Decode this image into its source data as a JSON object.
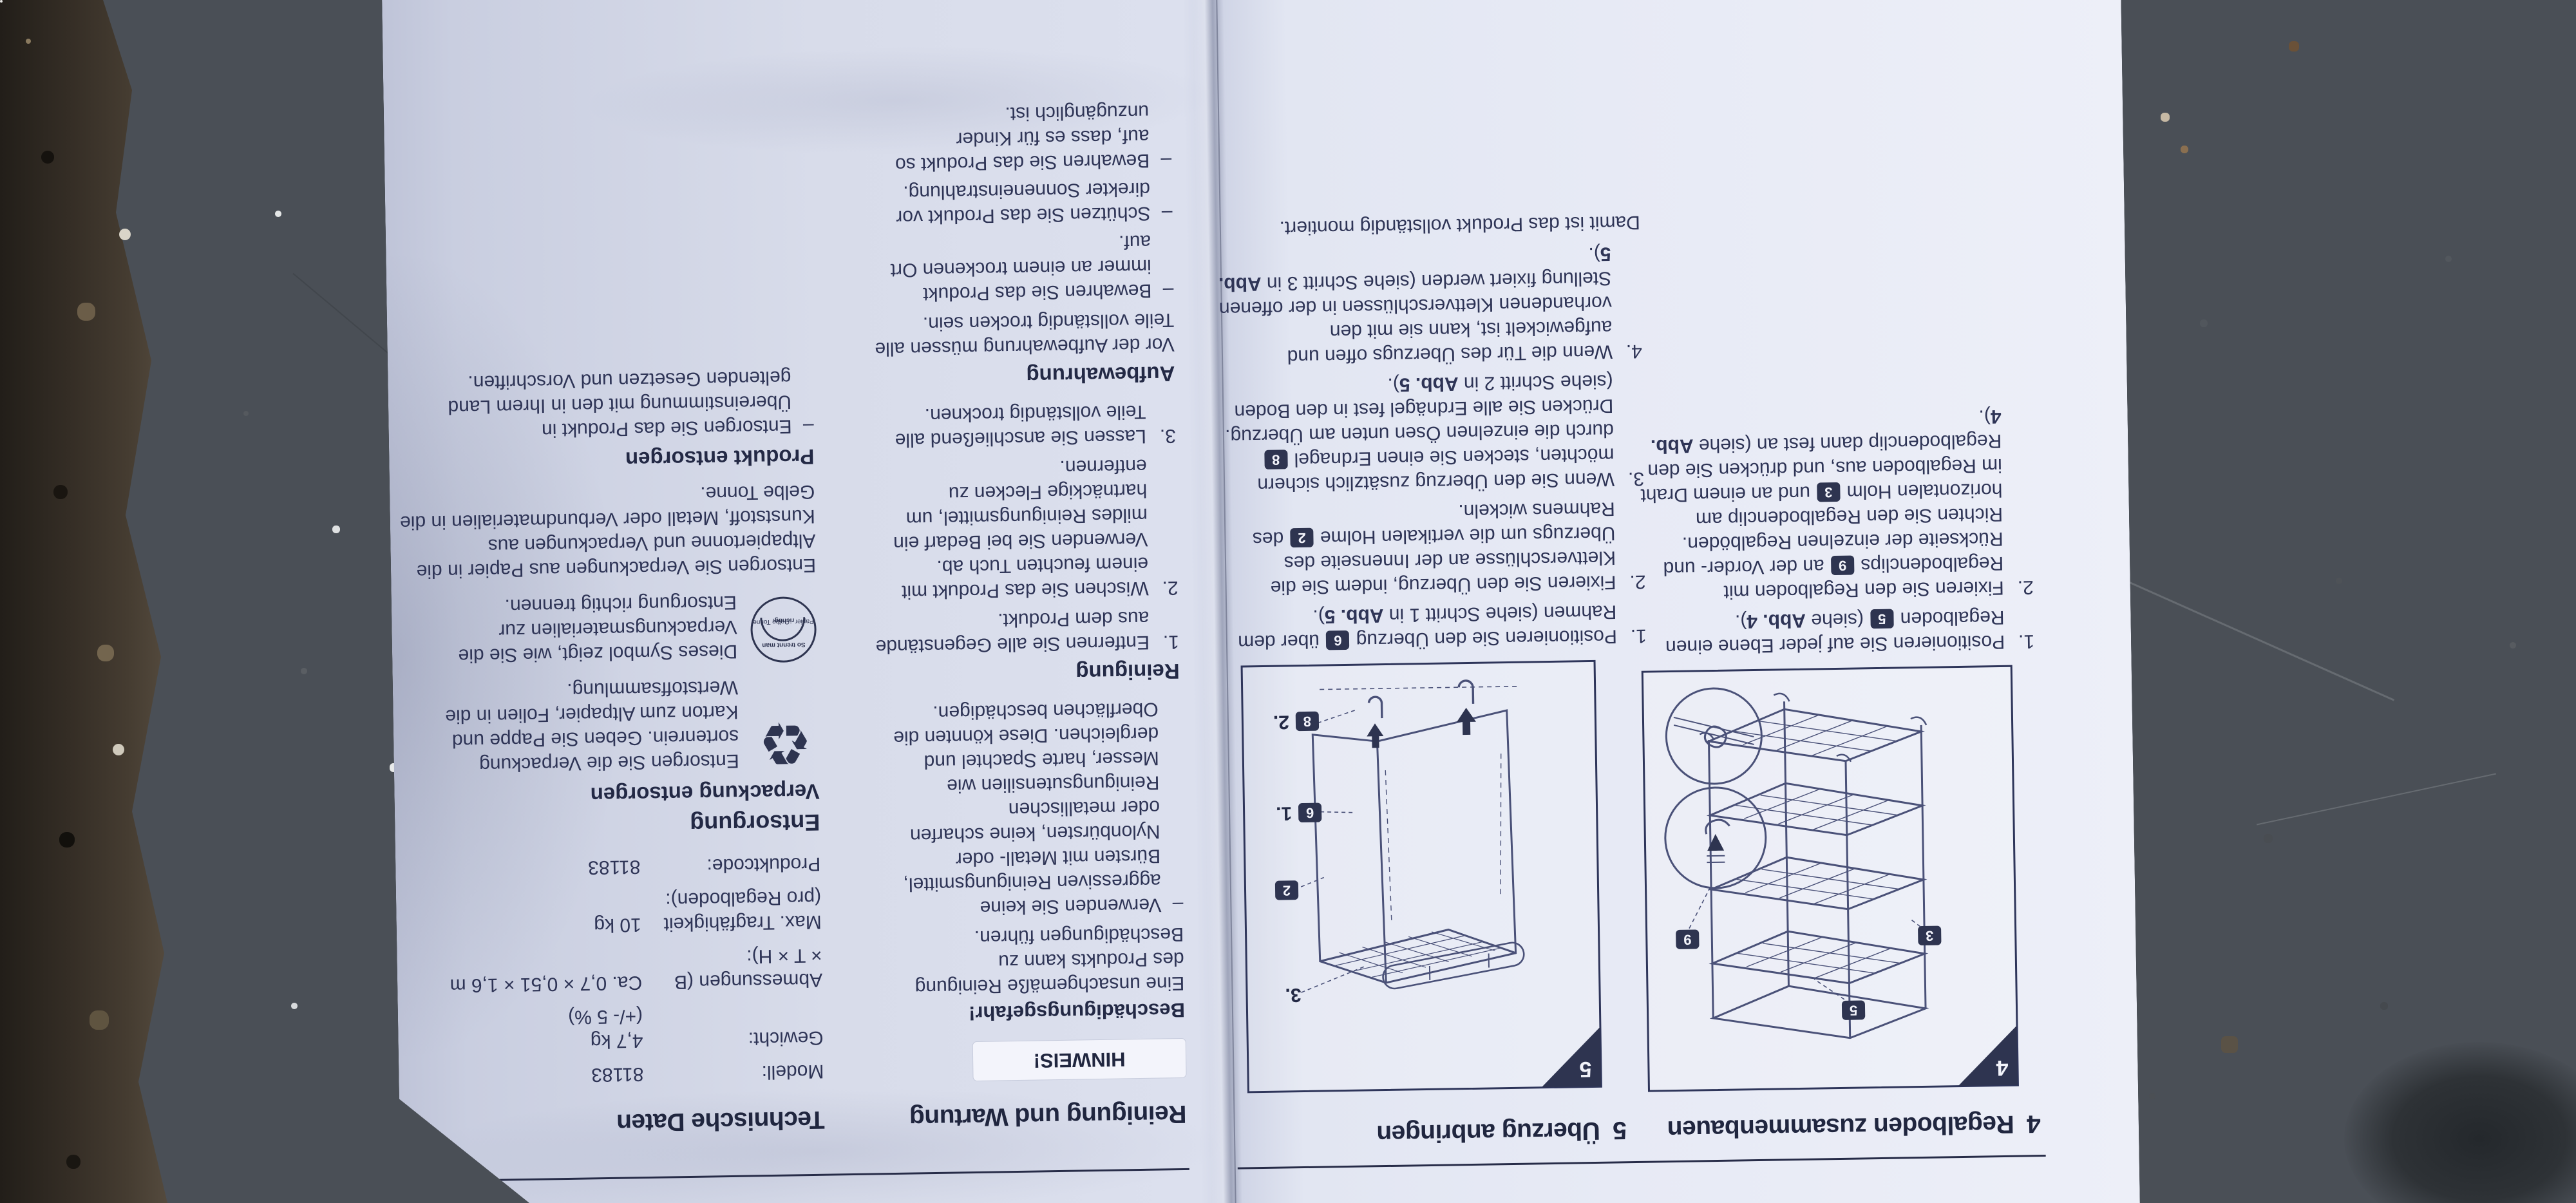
{
  "scene": {
    "surface": "weathered concrete ground with dark rubble strip",
    "colors": {
      "concrete_light": "#a2a7ae",
      "concrete_dark": "#5c636b",
      "rubble": "#342d25",
      "paper": "#e2e6f2",
      "ink": "#2e3456",
      "badge": "#2e3450"
    },
    "icons": {
      "recycle": "recycling-symbol",
      "sorting": "waste-sorting-circle-symbol"
    }
  },
  "page_assembly": {
    "section4": {
      "number": "4",
      "title": "Regalboden zusammenbauen",
      "figure": {
        "label": "4",
        "badge_shelf": "5",
        "badge_holm": "3",
        "badge_clip": "9"
      },
      "steps": [
        "Positionieren Sie auf jeder Ebene einen Regalboden [[5]] (siehe **Abb. 4**).",
        "Fixieren Sie den Regalboden mit Regalbodenclips [[9]] an der Vorder- und Rückseite der einzelnen Regalböden. Richten Sie den Regalbodenclip am horizontalen Holm [[3]] und an einem Draht im Regalboden aus, und drücken Sie den Regalbodenclip dann fest an (siehe **Abb. 4**)."
      ]
    },
    "section5": {
      "number": "5",
      "title": "Überzug anbringen",
      "figure": {
        "label": "5",
        "label_step1": "1.",
        "label_step2": "2.",
        "label_step3": "3.",
        "badge_cover": "6",
        "badge_peg": "8",
        "badge_pole": "2"
      },
      "steps": [
        "Positionieren Sie den Überzug [[6]] über dem Rahmen (siehe Schritt 1 in **Abb. 5**).",
        "Fixieren Sie den Überzug, indem Sie die Klettverschlüsse an der Innenseite des Überzugs um die vertikalen Holme [[2]] des Rahmens wickeln.",
        "Wenn Sie den Überzug zusätzlich sichern möchten, stecken Sie einen Erdnagel [[8]] durch die einzelnen Ösen unten am Überzug. Drücken Sie alle Erdnägel fest in den Boden (siehe Schritt 2 in **Abb. 5**).",
        "Wenn die Tür des Überzugs offen und aufgewickelt ist, kann sie mit den vorhandenen Klettverschlüssen in der offenen Stellung fixiert werden (siehe Schritt 3 in **Abb. 5**)."
      ],
      "closing": "Damit ist das Produkt vollständig montiert."
    }
  },
  "page_care": {
    "title": "Reinigung und Wartung",
    "notice": "HINWEIS!",
    "warning": {
      "title": "Beschädigungsgefahr!",
      "intro": "Eine unsachgemäße Reinigung des Produkts kann zu Beschädigungen führen.",
      "bullets": [
        "Verwenden Sie keine aggressiven Reinigungsmittel, Bürsten mit Metall- oder Nylonbürsten, keine scharfen oder metallischen Reinigungsutensilien wie Messer, harte Spachtel und dergleichen. Diese könnten die Oberflächen beschädigen."
      ]
    },
    "cleaning": {
      "title": "Reinigung",
      "steps": [
        "Entfernen Sie alle Gegenstände aus dem Produkt.",
        "Wischen Sie das Produkt mit einem feuchten Tuch ab. Verwenden Sie bei Bedarf ein mildes Reinigungsmittel, um hartnäckige Flecken zu entfernen.",
        "Lassen Sie anschließend alle Teile vollständig trocknen."
      ]
    },
    "storage": {
      "title": "Aufbewahrung",
      "intro": "Vor der Aufbewahrung müssen alle Teile vollständig trocken sein.",
      "bullets": [
        "Bewahren Sie das Produkt immer an einem trockenen Ort auf.",
        "Schützen Sie das Produkt vor direkter Sonneneinstrahlung.",
        "Bewahren Sie das Produkt so auf, dass es für Kinder unzugänglich ist."
      ]
    }
  },
  "page_tech": {
    "title": "Technische Daten",
    "table": [
      {
        "label": "Modell:",
        "value": "81183"
      },
      {
        "label": "Gewicht:",
        "value": "4,7 kg\n(+/- 5 %)"
      },
      {
        "label": "Abmessungen (B × T × H):",
        "value": "Ca. 0,7 × 0,51 × 1,6 m"
      },
      {
        "label": "Max. Tragfähigkeit (pro Regalboden):",
        "value": "10 kg"
      },
      {
        "label": "Produktcode:",
        "value": "81183"
      }
    ],
    "disposal": {
      "title": "Entsorgung",
      "packaging": {
        "title": "Verpackung entsorgen",
        "recycle_text": "Entsorgen Sie die Verpackung sortenrein. Geben Sie Pappe und Karton zum Altpapier, Folien in die Wertstoffsammlung.",
        "sorting_label_top": "So trennt man richtig:",
        "sorting_label_bottom": "Papier · Gelbe Tonne",
        "symbol_text": "Dieses Symbol zeigt, wie Sie die Verpackungsmaterialien zur Entsorgung richtig trennen.",
        "extra": "Entsorgen Sie Verpackungen aus Papier in die Altpapiertonne und Verpackungen aus Kunststoff, Metall oder Verbundmaterialien in die Gelbe Tonne."
      },
      "product": {
        "title": "Produkt entsorgen",
        "bullets": [
          "Entsorgen Sie das Produkt in Übereinstimmung mit den in Ihrem Land geltenden Gesetzen und Vorschriften."
        ]
      }
    }
  }
}
